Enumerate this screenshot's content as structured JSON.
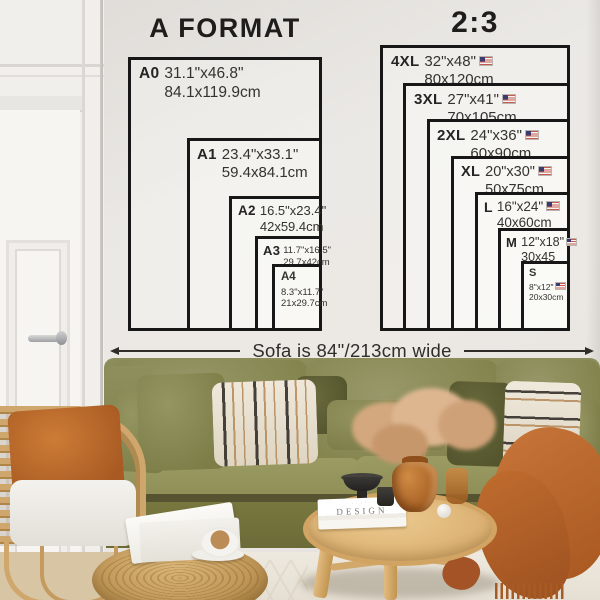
{
  "left_chart": {
    "title": "A FORMAT",
    "sizes": [
      {
        "label": "A0",
        "inches": "31.1\"x46.8\"",
        "cm": "84.1x119.9cm"
      },
      {
        "label": "A1",
        "inches": "23.4\"x33.1\"",
        "cm": "59.4x84.1cm"
      },
      {
        "label": "A2",
        "inches": "16.5\"x23.4\"",
        "cm": "42x59.4cm"
      },
      {
        "label": "A3",
        "inches": "11.7\"x16.5\"",
        "cm": "29.7x42cm"
      },
      {
        "label": "A4",
        "inches": "8.3\"x11.7\"",
        "cm": "21x29.7cm"
      }
    ]
  },
  "right_chart": {
    "title": "2:3",
    "sizes": [
      {
        "label": "4XL",
        "inches": "32\"x48\"",
        "cm": "80x120cm",
        "flag": "US"
      },
      {
        "label": "3XL",
        "inches": "27\"x41\"",
        "cm": "70x105cm",
        "flag": "US"
      },
      {
        "label": "2XL",
        "inches": "24\"x36\"",
        "cm": "60x90cm",
        "flag": "US"
      },
      {
        "label": "XL",
        "inches": "20\"x30\"",
        "cm": "50x75cm",
        "flag": "US"
      },
      {
        "label": "L",
        "inches": "16\"x24\"",
        "cm": "40x60cm",
        "flag": "US"
      },
      {
        "label": "M",
        "inches": "12\"x18\"",
        "cm": "30x45",
        "flag": "US"
      },
      {
        "label": "S",
        "inches": "8\"x12\"",
        "cm": "20x30cm",
        "flag": "US"
      }
    ]
  },
  "annotation": {
    "sofa_width": "Sofa is 84\"/213cm wide"
  },
  "decor": {
    "book_title": "DESIGN"
  },
  "colors": {
    "chart_line": "#171717",
    "wall": "#e9e6e2",
    "sofa_olive": "#8a8a57",
    "pillow_rust": "#bf6c2e",
    "throw_rust": "#b5612a",
    "wood": "#dcb278",
    "rattan": "#cda66c"
  }
}
